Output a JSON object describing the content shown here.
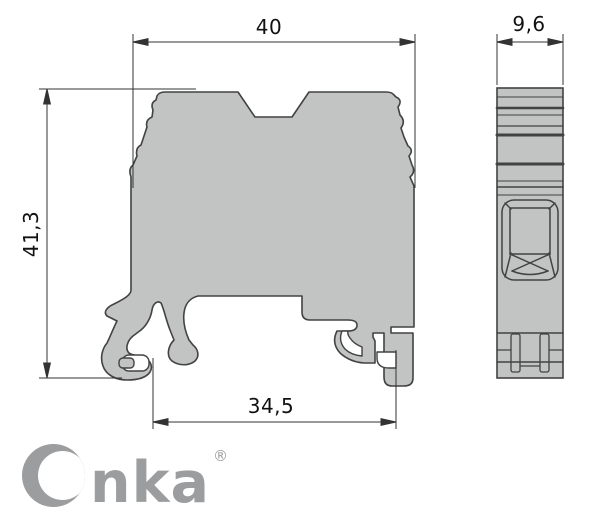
{
  "dimensions": {
    "top_width": "40",
    "side_width": "9,6",
    "height": "41,3",
    "bottom_width": "34,5"
  },
  "logo": {
    "name": "Onka",
    "text_remainder": "nka",
    "registered_mark": "®"
  },
  "colors": {
    "body_fill": "#C2C3C3",
    "outline": "#424242",
    "dimension_line": "#333333",
    "label_text": "#111111",
    "logo_gray": "#9C9D9E",
    "background": "#FFFFFF"
  }
}
